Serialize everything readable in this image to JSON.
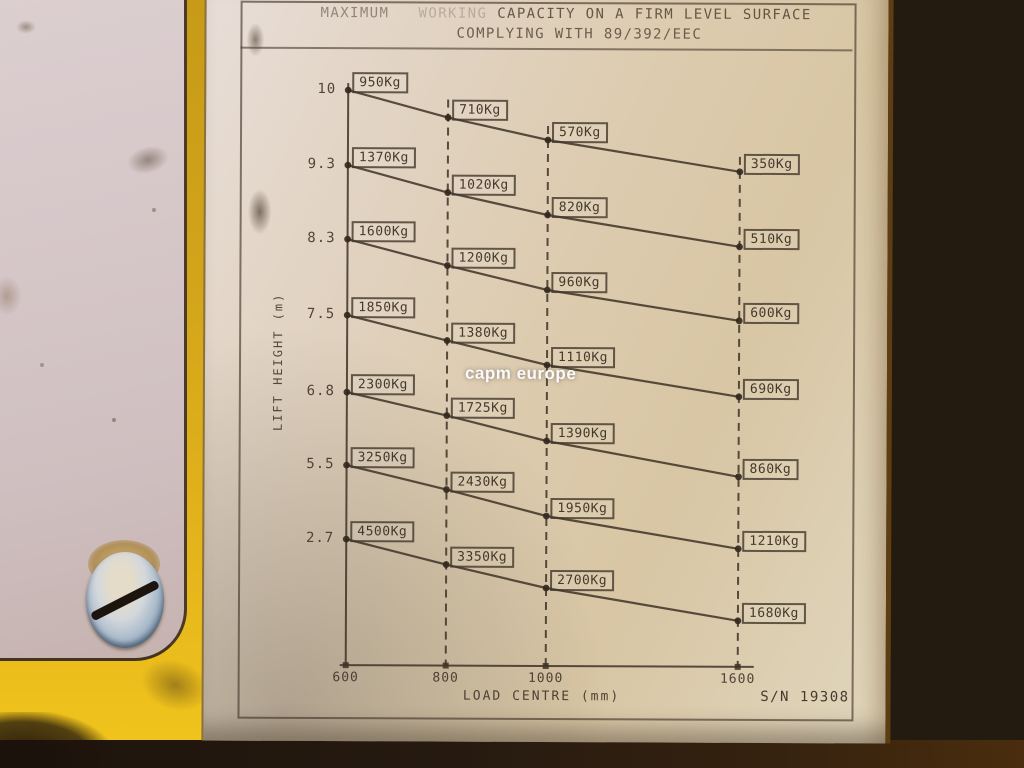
{
  "plate": {
    "title_prefix": "MAXIMUM",
    "title_faded": "WORKING",
    "title_rest": "CAPACITY ON A FIRM LEVEL SURFACE",
    "subtitle": "COMPLYING WITH 89/392/EEC",
    "serial_number": "S/N 19308",
    "watermark": "capm europe"
  },
  "chart_data": {
    "type": "line",
    "title": "MAXIMUM WORKING CAPACITY ON A FIRM LEVEL SURFACE",
    "subtitle": "COMPLYING WITH 89/392/EEC",
    "xlabel": "LOAD CENTRE (mm)",
    "ylabel": "LIFT HEIGHT (m)",
    "x": [
      600,
      800,
      1000,
      1600
    ],
    "x_tick_labels": [
      "600",
      "800",
      "1000",
      "1600"
    ],
    "y_tick_labels": [
      "10",
      "9.3",
      "8.3",
      "7.5",
      "6.8",
      "5.5",
      "2.7"
    ],
    "unit": "Kg",
    "grid": "dashed-vertical",
    "legend": "none",
    "series": [
      {
        "name": "lift height 10 m",
        "lift_height_m": 10,
        "values": [
          950,
          710,
          570,
          350
        ],
        "labels": [
          "950Kg",
          "710Kg",
          "570Kg",
          "350Kg"
        ]
      },
      {
        "name": "lift height 9.3 m",
        "lift_height_m": 9.3,
        "values": [
          1370,
          1020,
          820,
          510
        ],
        "labels": [
          "1370Kg",
          "1020Kg",
          "820Kg",
          "510Kg"
        ]
      },
      {
        "name": "lift height 8.3 m",
        "lift_height_m": 8.3,
        "values": [
          1600,
          1200,
          960,
          600
        ],
        "labels": [
          "1600Kg",
          "1200Kg",
          "960Kg",
          "600Kg"
        ]
      },
      {
        "name": "lift height 7.5 m",
        "lift_height_m": 7.5,
        "values": [
          1850,
          1380,
          1110,
          690
        ],
        "labels": [
          "1850Kg",
          "1380Kg",
          "1110Kg",
          "690Kg"
        ]
      },
      {
        "name": "lift height 6.8 m",
        "lift_height_m": 6.8,
        "values": [
          2300,
          1725,
          1390,
          860
        ],
        "labels": [
          "2300Kg",
          "1725Kg",
          "1390Kg",
          "860Kg"
        ]
      },
      {
        "name": "lift height 5.5 m",
        "lift_height_m": 5.5,
        "values": [
          3250,
          2430,
          1950,
          1210
        ],
        "labels": [
          "3250Kg",
          "2430Kg",
          "1950Kg",
          "1210Kg"
        ]
      },
      {
        "name": "lift height 2.7 m",
        "lift_height_m": 2.7,
        "values": [
          4500,
          3350,
          2700,
          1680
        ],
        "labels": [
          "4500Kg",
          "3350Kg",
          "2700Kg",
          "1680Kg"
        ]
      }
    ]
  },
  "colors": {
    "plate_background": "#dccbae",
    "chart_ink": "#4a3c30",
    "machine_yellow": "#d9ab17",
    "machine_orange": "#cf7f0f",
    "panel_pink_grey": "#d4c5c6",
    "shadow_strip": "#261a10",
    "watermark_color": "#ffffff"
  }
}
